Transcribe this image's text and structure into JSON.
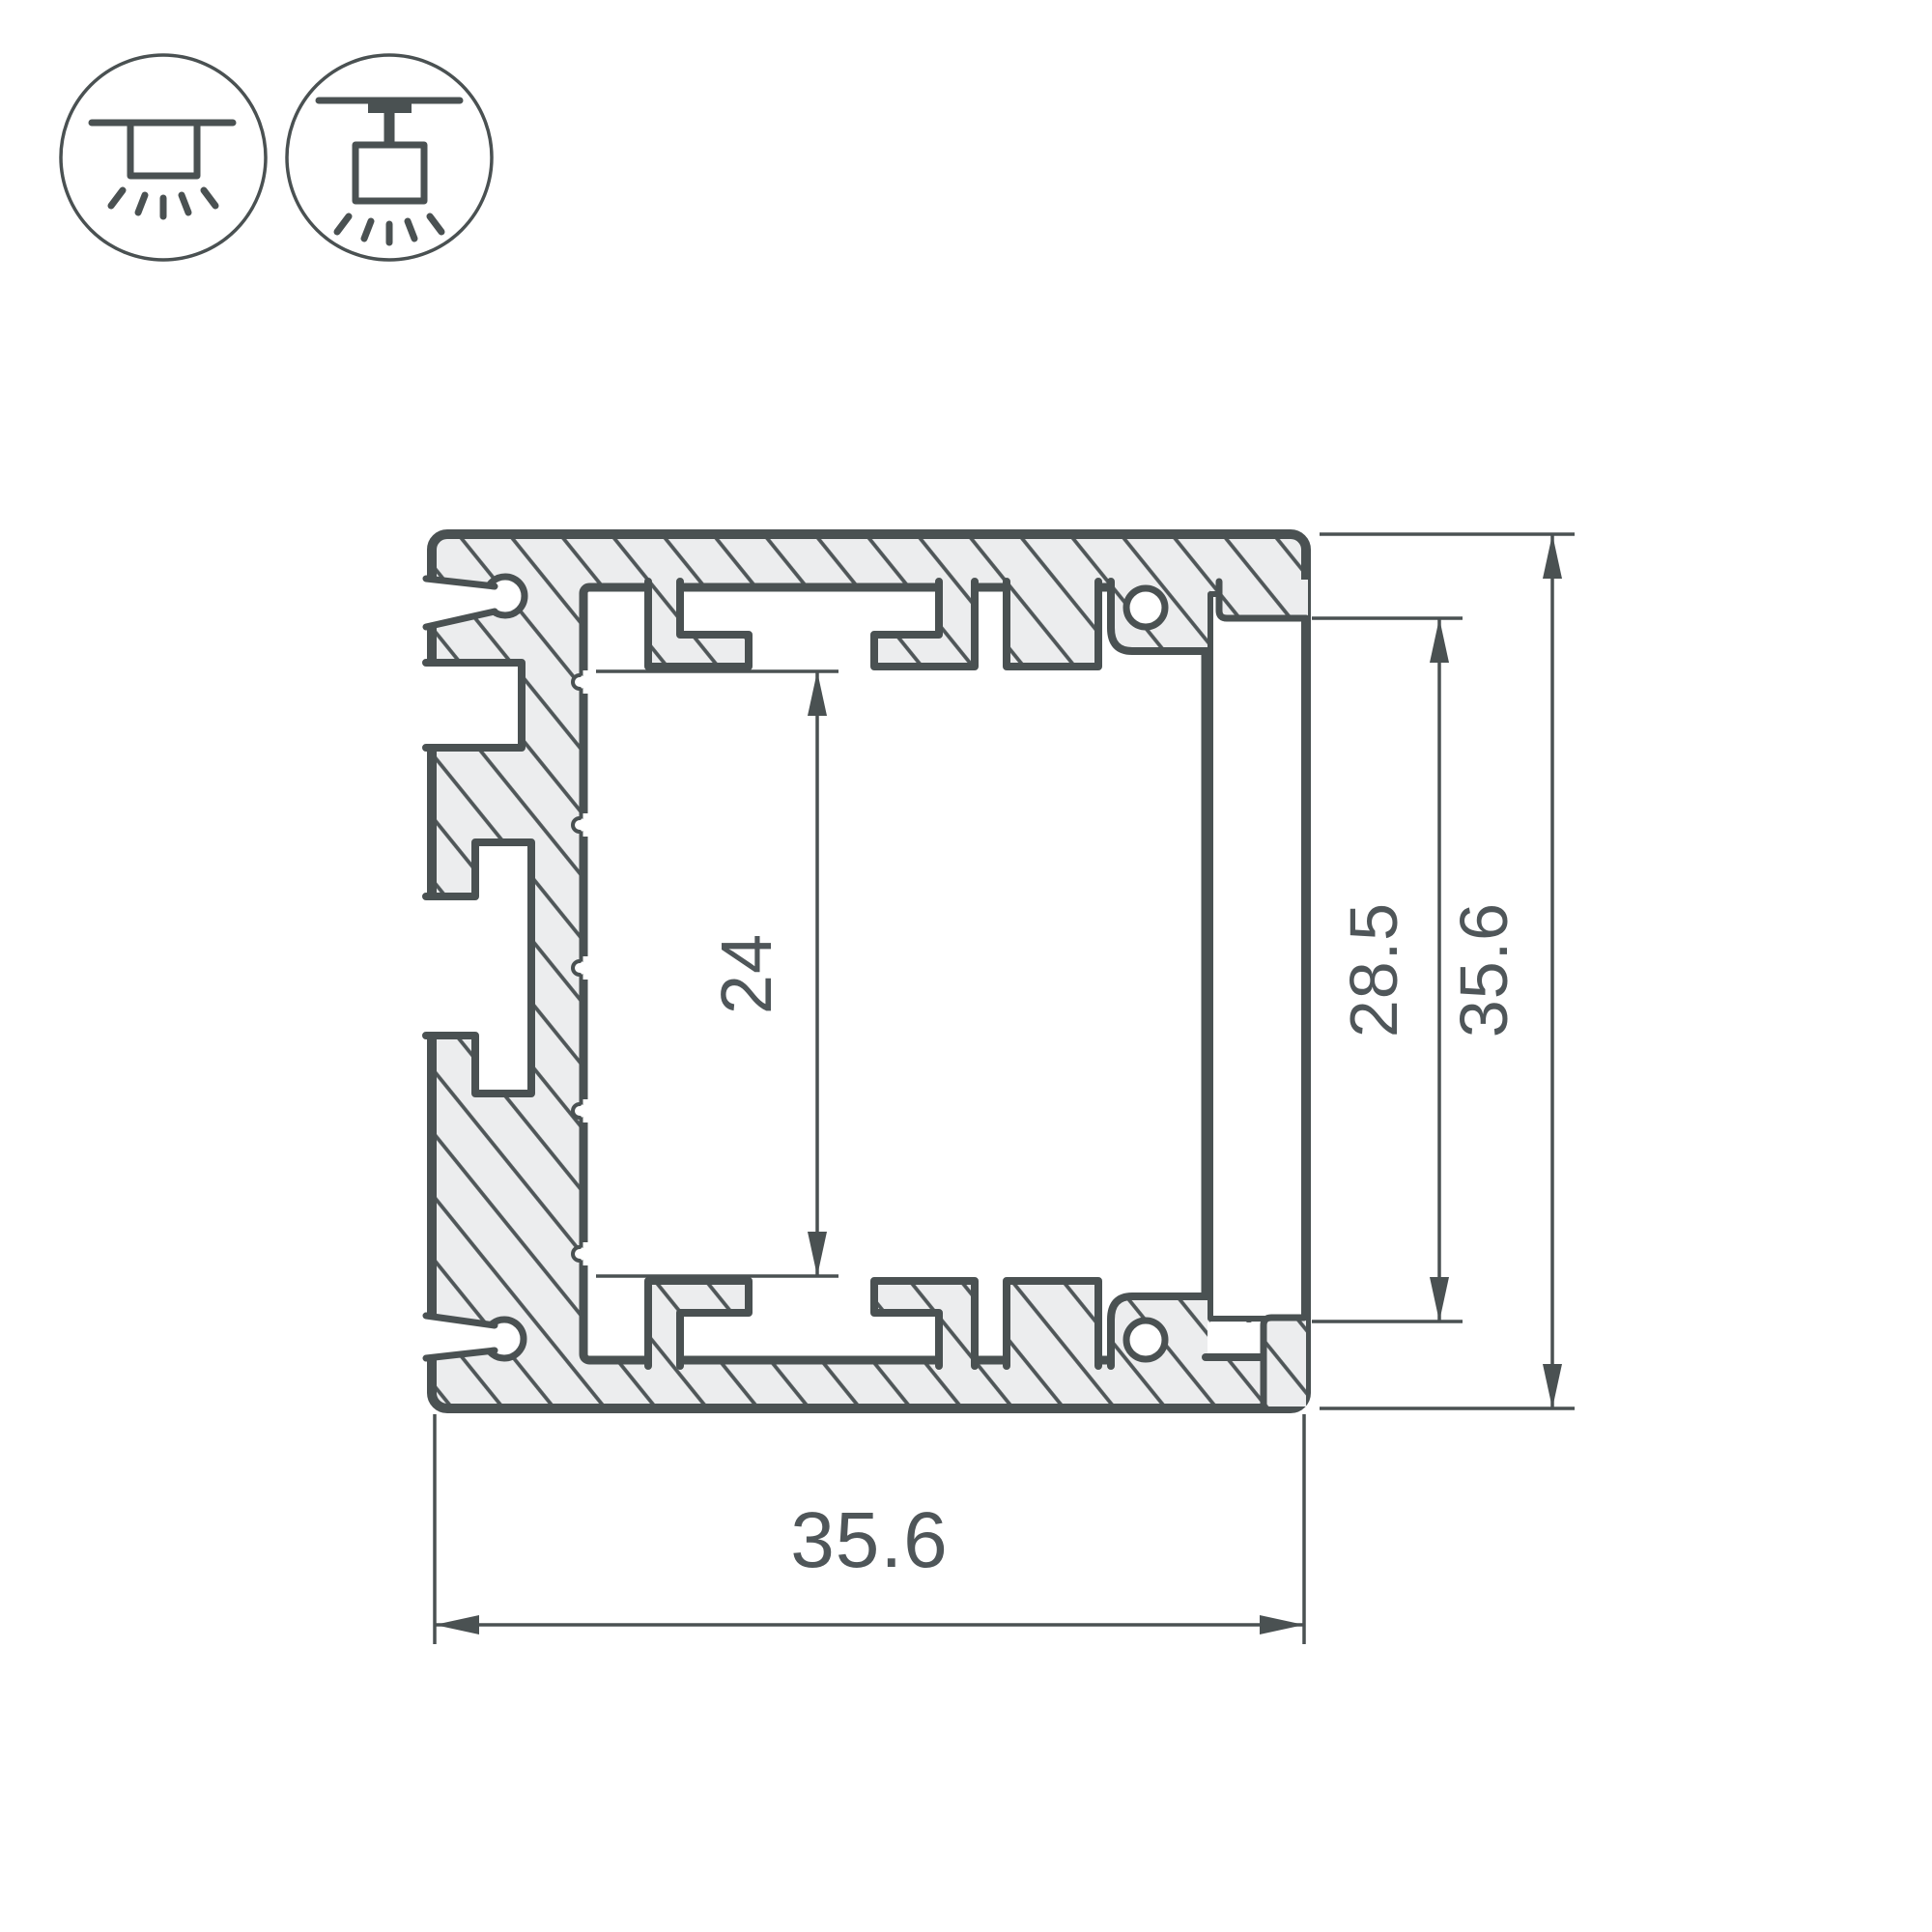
{
  "drawing": {
    "type": "technical-cross-section",
    "subject": "aluminum LED profile cross-section with diffuser screen",
    "dimensions": {
      "inner_channel_height": "24",
      "screen_visible_height": "28.5",
      "overall_height": "35.6",
      "overall_width": "35.6"
    },
    "units": "mm"
  },
  "icons": {
    "left": "surface-ceiling-mount-light",
    "right": "suspended-pendant-mount-light"
  },
  "colors": {
    "background": "#ffffff",
    "outline": "#4a5152",
    "hatch_line": "#4f5658",
    "aluminum_fill": "#ecedee",
    "label_text": "#4f5659"
  }
}
